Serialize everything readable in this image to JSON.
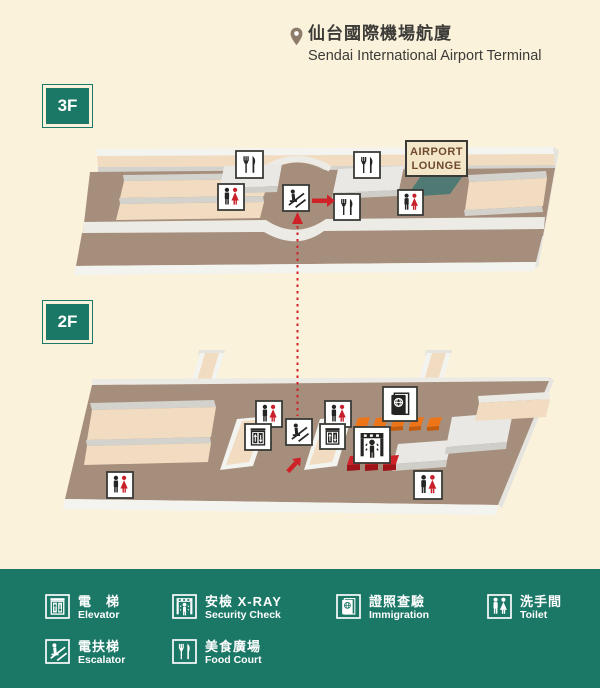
{
  "title": {
    "zh": "仙台國際機場航廈",
    "en": "Sendai International Airport Terminal"
  },
  "floors": {
    "f3": {
      "label": "3F",
      "markers": [
        "food-court",
        "toilet",
        "escalator",
        "food-court",
        "food-court",
        "toilet"
      ]
    },
    "f2": {
      "label": "2F",
      "markers": [
        "toilet",
        "elevator",
        "escalator",
        "toilet",
        "elevator",
        "security-check",
        "immigration",
        "toilet",
        "toilet"
      ]
    }
  },
  "lounge": {
    "line1": "AIRPORT",
    "line2": "LOUNGE"
  },
  "legend": {
    "items": [
      {
        "id": "elevator",
        "icon": "elevator-icon",
        "zh": "電　梯",
        "en": "Elevator"
      },
      {
        "id": "escalator",
        "icon": "escalator-icon",
        "zh": "電扶梯",
        "en": "Escalator"
      },
      {
        "id": "security",
        "icon": "security-check-icon",
        "zh": "安檢 X-RAY",
        "en": "Security Check"
      },
      {
        "id": "food_court",
        "icon": "food-court-icon",
        "zh": "美食廣場",
        "en": "Food Court"
      },
      {
        "id": "immigration",
        "icon": "immigration-icon",
        "zh": "證照查驗",
        "en": "Immigration"
      },
      {
        "id": "toilet",
        "icon": "toilet-icon",
        "zh": "洗手間",
        "en": "Toilet"
      }
    ]
  },
  "colors": {
    "background": "#fbf2dc",
    "legend_green": "#1b7766",
    "floor_brown": "#a68e7c",
    "floor_tan": "#f2dcc1",
    "wall_gray": "#d4d2cc",
    "face_white": "#f3f3f0",
    "lounge_teal": "#4e7a73",
    "accent_red": "#cf2128",
    "accent_red_dark": "#9e1419",
    "accent_orange": "#ee7517",
    "accent_orange_dark": "#c45c0e",
    "icon_ink": "#242422",
    "icon_red": "#c8202a",
    "sign_bg": "#f4e6c8",
    "sign_text": "#6e4a2f",
    "title_ink": "#3c3b37",
    "pin_brown": "#8d7c6a"
  }
}
